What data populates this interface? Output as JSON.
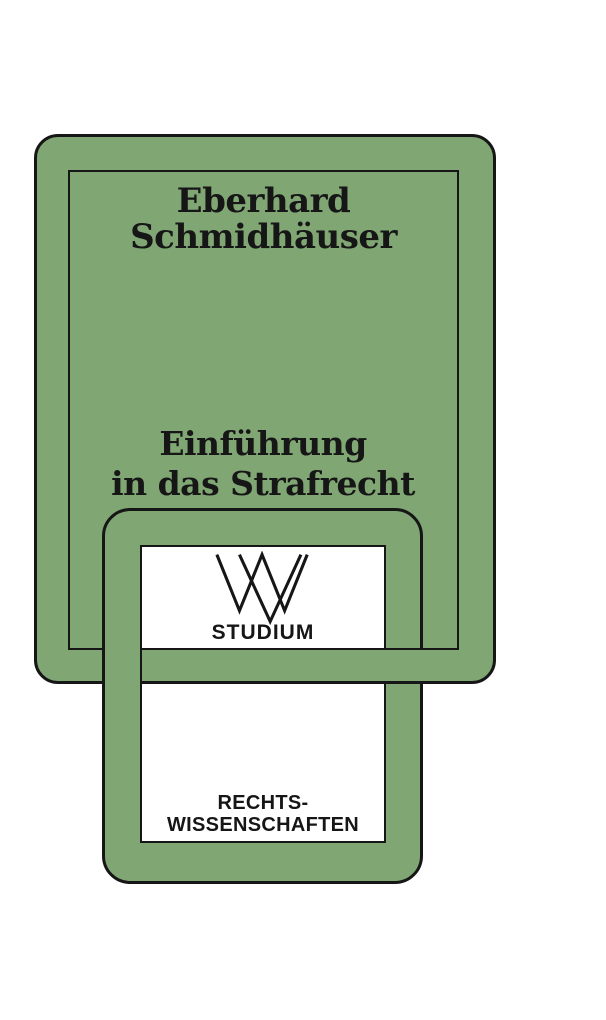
{
  "cover": {
    "author_line1": "Eberhard",
    "author_line2": "Schmidhäuser",
    "title_line1": "Einführung",
    "title_line2": "in das Strafrecht",
    "series": {
      "logo": "wv-monogram-icon",
      "series_label": "STUDIUM",
      "category_line1": "RECHTS-",
      "category_line2": "WISSENSCHAFTEN"
    },
    "colors": {
      "cover_green": "#80a674",
      "outline_ink": "#161616",
      "panel_white": "#ffffff",
      "page_background": "#ffffff"
    }
  }
}
